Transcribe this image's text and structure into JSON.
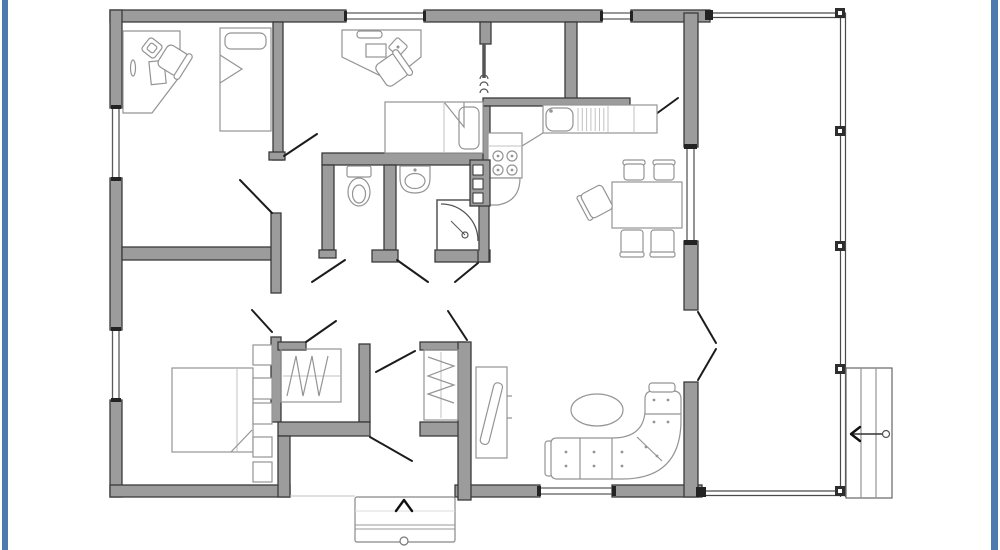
{
  "page": {
    "title": "House floor plan drawing",
    "background": "#ffffff"
  },
  "colors": {
    "frame_accent": "#4d79ae",
    "wall_fill": "#9c9c9c",
    "wall_outline": "#3b3b3b",
    "furniture_line": "#949494",
    "door_line": "#1c1c1c",
    "window_line": "#5a5a5a",
    "deck_line": "#4a4a4a"
  },
  "floor_plan": {
    "description": "Black-and-white architectural floor plan of a single-storey three-bedroom house with WC, shower bathroom, storage room, kitchen with L-shaped counter, dining area, living area with corner sofa, entry vestibule with two closets and outside steps, and a full-height deck along the right side with its own steps",
    "rooms": [
      {
        "id": "bedroom-1",
        "label": "Bedroom 1 (top left): desk, desk chair, single bed"
      },
      {
        "id": "bedroom-2",
        "label": "Bedroom 2 (top middle): desk, desk chair, single bed"
      },
      {
        "id": "bedroom-3",
        "label": "Bedroom 3 (bottom left): double bed, nightstands, closet"
      },
      {
        "id": "wc",
        "label": "WC: toilet"
      },
      {
        "id": "bathroom",
        "label": "Bathroom: washbasin, corner shower"
      },
      {
        "id": "storage",
        "label": "Storage room (top centre)"
      },
      {
        "id": "kitchen",
        "label": "Kitchen: sink with drainboard, 4-burner stove, appliance column, L-shaped counter"
      },
      {
        "id": "dining-area",
        "label": "Dining area: table with five chairs"
      },
      {
        "id": "living-area",
        "label": "Living area: corner sofa, oval coffee table, TV stand"
      },
      {
        "id": "entry-hall",
        "label": "Entry hall with two wardrobe closets and front door"
      },
      {
        "id": "deck",
        "label": "Deck / porch along right side with posts"
      }
    ],
    "features": {
      "front_steps_arrow": "up",
      "deck_steps_arrow": "left",
      "window_count": 6,
      "exterior_doors": 2
    }
  }
}
